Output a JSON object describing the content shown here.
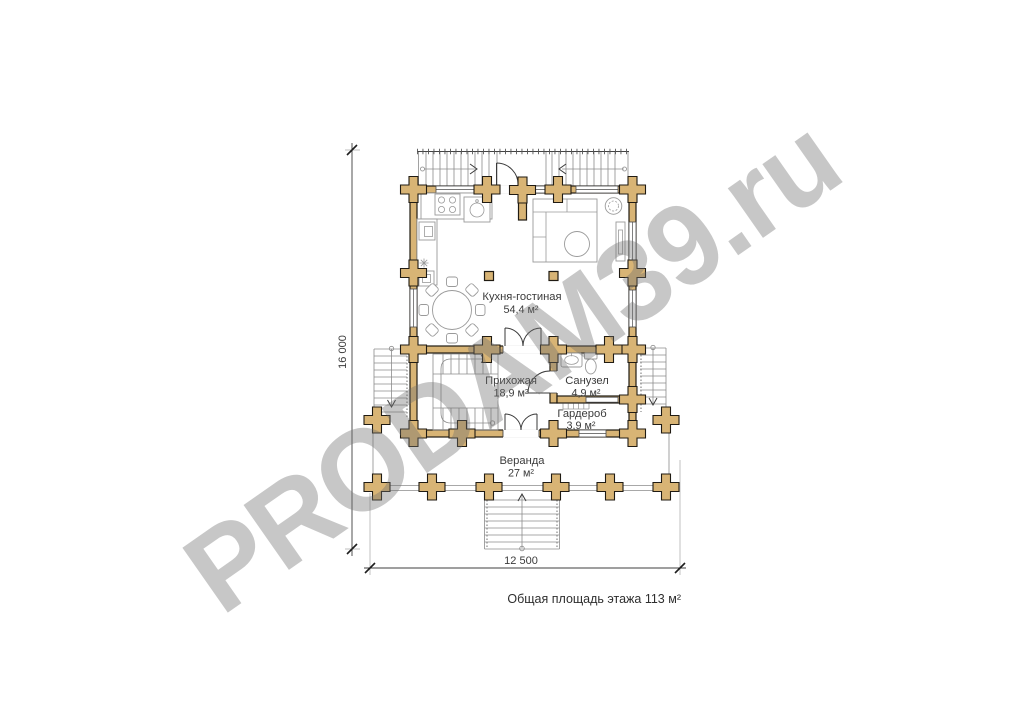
{
  "watermark": {
    "text": "PRODAM39.ru"
  },
  "rooms": [
    {
      "id": "kitchen-living",
      "name": "Кухня-гостиная",
      "area": "54,4 м²"
    },
    {
      "id": "hallway",
      "name": "Прихожая",
      "area": "18,9 м²"
    },
    {
      "id": "bathroom",
      "name": "Санузел",
      "area": "4,9 м²"
    },
    {
      "id": "wardrobe",
      "name": "Гардероб",
      "area": "3,9 м²"
    },
    {
      "id": "veranda",
      "name": "Веранда",
      "area": "27 м²"
    }
  ],
  "dimensions": {
    "height_label": "16 000",
    "width_label": "12 500"
  },
  "footer": {
    "total_area": "Общая площадь этажа 113 м²"
  },
  "colors": {
    "log_wall": "#d8b475",
    "outline": "#201b13",
    "watermark_gray": "#c8c8c8"
  }
}
